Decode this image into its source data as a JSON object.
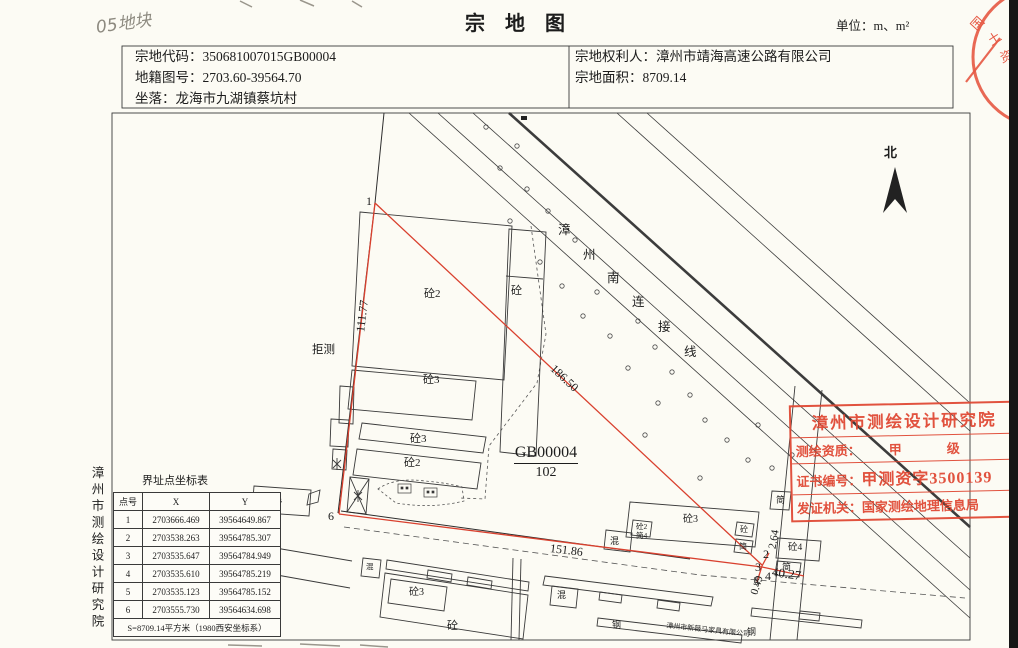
{
  "page": {
    "title": "宗　地　图",
    "unit_label": "单位：m、m²",
    "handwritten_note": "05地块"
  },
  "header": {
    "left": [
      {
        "label": "宗地代码：",
        "value": "350681007015GB00004"
      },
      {
        "label": "地籍图号：",
        "value": "2703.60-39564.70"
      },
      {
        "label": "坐落：",
        "value": "龙海市九湖镇蔡坑村"
      }
    ],
    "right": [
      {
        "label": "宗地权利人：",
        "value": "漳州市靖海高速公路有限公司"
      },
      {
        "label": "宗地面积：",
        "value": "8709.14"
      }
    ]
  },
  "map": {
    "parcel_number": "GB00004",
    "parcel_denominator": "102",
    "points": {
      "p1": "1",
      "p2": "2",
      "p3": "3",
      "p4": "4",
      "p5": "5",
      "p6": "6"
    },
    "distances": {
      "w111": "111.77",
      "diag": "186.50",
      "s151": "151.86",
      "d264": "2.64",
      "d049": "0.49",
      "d4027": "40.27"
    },
    "road_name_chars": [
      "漳",
      "州",
      "南",
      "连",
      "接",
      "线"
    ],
    "labels": {
      "tong2": "砼2",
      "tong3": "砼3",
      "tong": "砼",
      "tong4": "砼4",
      "hun": "混",
      "jian": "简",
      "jian4": "简4",
      "gang": "钢",
      "refused": "拒测",
      "north": "北"
    },
    "company": "漳州市新薇马家具有限公司"
  },
  "table": {
    "title": "界址点坐标表",
    "headers": [
      "点号",
      "X",
      "Y"
    ],
    "rows": [
      [
        "1",
        "2703666.469",
        "39564649.867"
      ],
      [
        "2",
        "2703538.263",
        "39564785.307"
      ],
      [
        "3",
        "2703535.647",
        "39564784.949"
      ],
      [
        "4",
        "2703535.610",
        "39564785.219"
      ],
      [
        "5",
        "2703535.123",
        "39564785.152"
      ],
      [
        "6",
        "2703555.730",
        "39564634.698"
      ]
    ],
    "footer": "S=8709.14平方米（1980西安坐标系）"
  },
  "side_text": "漳州市测绘设计研究院",
  "stamp_box": {
    "line1": "漳州市测绘设计研究院",
    "line2_label": "测绘资质：",
    "line2_value": "甲　级",
    "line3_label": "证书编号：",
    "line3_value": "甲测资字3500139",
    "line4_label": "发证机关：",
    "line4_value": "国家测绘地理信息局"
  },
  "corner_stamp_chars": [
    "国",
    "土",
    "资"
  ],
  "colors": {
    "boundary_red": "#d9402e",
    "stamp_red": "#df4631",
    "ink": "#1c1c1c"
  }
}
